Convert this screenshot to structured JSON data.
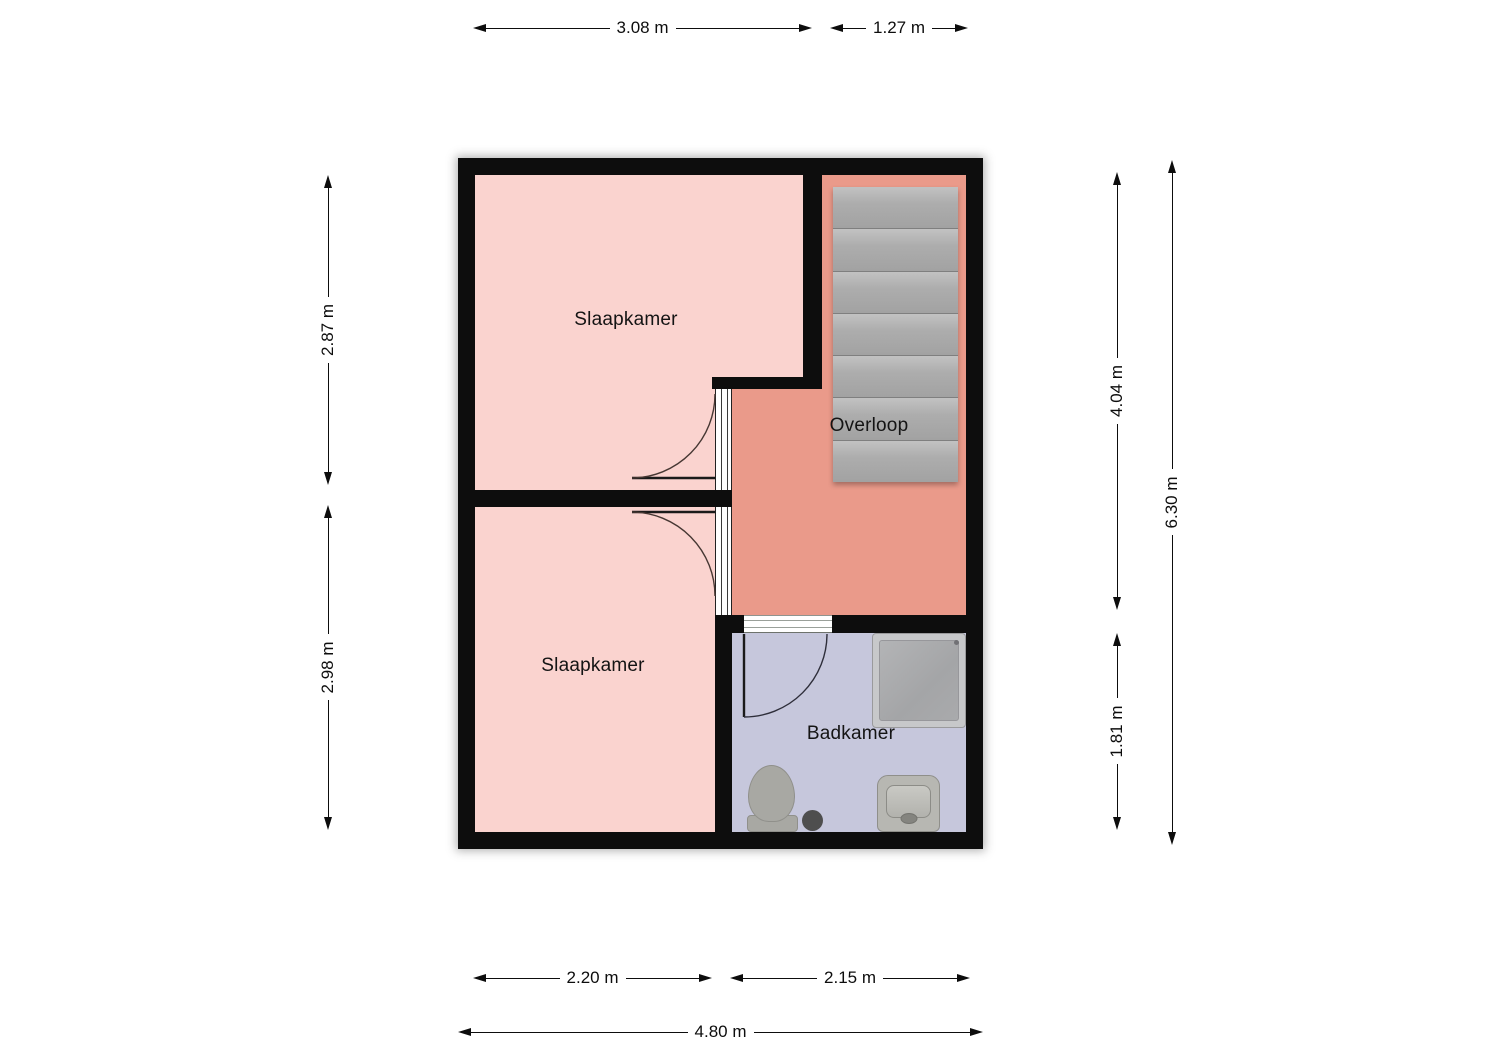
{
  "plan": {
    "type": "floorplan",
    "floor_label": ""
  },
  "rooms": {
    "bedroom_top": {
      "label": "Slaapkamer"
    },
    "bedroom_bottom": {
      "label": "Slaapkamer"
    },
    "landing": {
      "label": "Overloop"
    },
    "bathroom": {
      "label": "Badkamer"
    }
  },
  "stairs": {
    "steps": 7
  },
  "dimensions": {
    "top_bedroom_width": "3.08 m",
    "top_stairs_width": "1.27 m",
    "left_bedroom_top_height": "2.87 m",
    "left_bedroom_bottom_height": "2.98 m",
    "right_landing_height": "4.04 m",
    "right_bathroom_height": "1.81 m",
    "right_total_height": "6.30 m",
    "bottom_bedroom_width": "2.20 m",
    "bottom_bathroom_width": "2.15 m",
    "bottom_total_width": "4.80 m"
  },
  "colors": {
    "canvas_bg": "#ffffff",
    "wall": "#0d0d0d",
    "bedroom_floor": "#fad3cf",
    "landing_floor": "#ea9a8a",
    "bathroom_floor": "#c6c7dc",
    "stairs_tread": "#adadad",
    "fixture_gray": "#a8a8a3",
    "dimension_ink": "#0d0d0d",
    "label_ink": "#141414"
  }
}
